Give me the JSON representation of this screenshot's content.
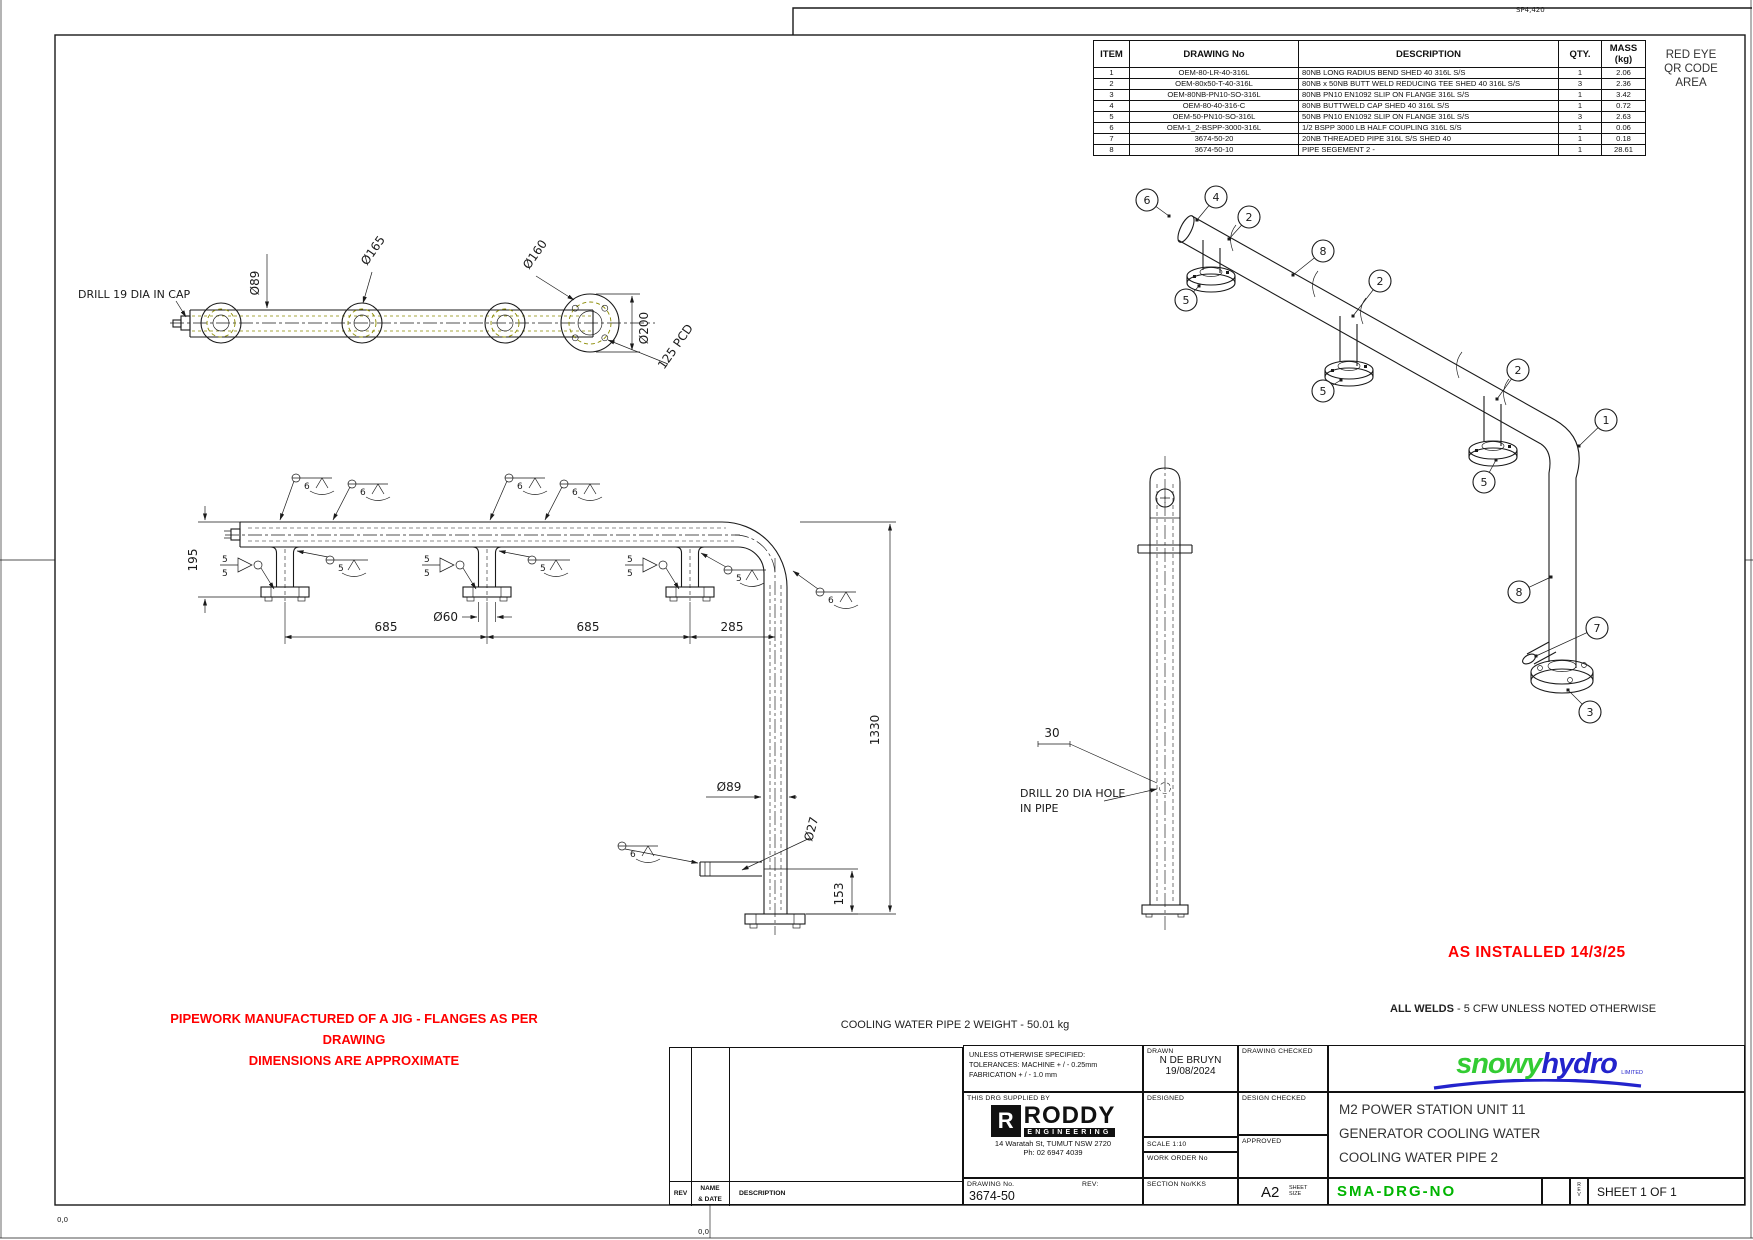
{
  "sheet": {
    "sp_mark": "SP4,420",
    "origin_a": "0,0",
    "origin_b": "0,0"
  },
  "qr_area": {
    "l1": "RED EYE",
    "l2": "QR CODE",
    "l3": "AREA"
  },
  "bom": {
    "headers": [
      "ITEM",
      "DRAWING No",
      "DESCRIPTION",
      "QTY.",
      "MASS (kg)"
    ],
    "rows": [
      [
        "1",
        "OEM-80-LR-40-316L",
        "80NB LONG RADIUS BEND SHED 40 316L S/S",
        "1",
        "2.06"
      ],
      [
        "2",
        "OEM-80x50-T-40-316L",
        "80NB x 50NB BUTT WELD REDUCING TEE SHED 40 316L S/S",
        "3",
        "2.36"
      ],
      [
        "3",
        "OEM-80NB-PN10-SO-316L",
        "80NB PN10 EN1092 SLIP ON FLANGE 316L S/S",
        "1",
        "3.42"
      ],
      [
        "4",
        "OEM-80-40-316-C",
        "80NB BUTTWELD CAP SHED 40 316L S/S",
        "1",
        "0.72"
      ],
      [
        "5",
        "OEM-50-PN10-SO-316L",
        "50NB PN10 EN1092 SLIP ON FLANGE 316L S/S",
        "3",
        "2.63"
      ],
      [
        "6",
        "OEM-1_2-BSPP-3000-316L",
        "1/2 BSPP 3000 LB HALF COUPLING 316L S/S",
        "1",
        "0.06"
      ],
      [
        "7",
        "3674-50-20",
        "20NB THREADED PIPE 316L S/S SHED 40",
        "1",
        "0.18"
      ],
      [
        "8",
        "3674-50-10",
        "PIPE SEGEMENT 2 -",
        "1",
        "28.61"
      ]
    ]
  },
  "notes": {
    "as_installed": "AS INSTALLED 14/3/25",
    "welds_bold": "ALL WELDS",
    "welds_rest": " - 5 CFW UNLESS NOTED OTHERWISE",
    "jig1": "PIPEWORK MANUFACTURED OF A JIG - FLANGES AS PER DRAWING",
    "jig2": "DIMENSIONS ARE APPROXIMATE",
    "weight": "COOLING WATER PIPE 2 WEIGHT -   50.01 kg"
  },
  "dims": {
    "drill19": "DRILL 19 DIA IN CAP",
    "d89_top": "Ø89",
    "d165": "Ø165",
    "d160": "Ø160",
    "d200": "Ø200",
    "pcd": "125 PCD",
    "h195": "195",
    "len685a": "685",
    "len685b": "685",
    "len285": "285",
    "d60": "Ø60",
    "d89_front": "Ø89",
    "v1330": "1330",
    "d27": "Ø27",
    "v153": "153",
    "off30": "30",
    "drill20_1": "DRILL 20 DIA HOLE",
    "drill20_2": "IN PIPE"
  },
  "welds": {
    "five": "5",
    "six": "6"
  },
  "iso": {
    "balloons": [
      "6",
      "4",
      "2",
      "8",
      "2",
      "5",
      "5",
      "2",
      "5",
      "1",
      "8",
      "7",
      "3"
    ]
  },
  "title_block": {
    "tol1": "UNLESS OTHERWISE SPECIFIED:",
    "tol2": "TOLERANCES: MACHINE + / - 0.25mm",
    "tol3": "FABRICATION + / - 1.0 mm",
    "supplied": "THIS DRG SUPPLIED BY",
    "roddy_r": "R",
    "roddy": "RODDY",
    "roddy_sub": "ENGINEERING",
    "addr1": "14 Waratah St, TUMUT NSW 2720",
    "addr2": "Ph: 02 6947 4039",
    "drg_no_label": "DRAWING No.",
    "rev_label": "REV:",
    "drg_no": "3674-50",
    "drawn_label": "DRAWN",
    "drawn_name": "N DE BRUYN",
    "drawn_date": "19/08/2024",
    "drawing_checked": "DRAWING CHECKED",
    "designed": "DESIGNED",
    "design_checked": "DESIGN CHECKED",
    "scale": "SCALE   1:10",
    "work_order": "WORK ORDER No",
    "approved": "APPROVED",
    "section": "SECTION No/KKS",
    "size": "A2",
    "size_l1": "SHEET",
    "size_l2": "SIZE",
    "title1": "M2 POWER STATION UNIT 11",
    "title2": "GENERATOR COOLING WATER",
    "title3": "COOLING WATER PIPE 2",
    "sma": "SMA-DRG-NO",
    "sheet": "SHEET 1 OF 1",
    "rev_v1": "R",
    "rev_v2": "E",
    "rev_v3": "V",
    "snowy": "snowy",
    "hydro": "hydro",
    "limited": "LIMITED"
  },
  "rev_table": {
    "rev": "REV",
    "name1": "NAME",
    "name2": "& DATE",
    "desc": "DESCRIPTION"
  },
  "colors": {
    "red": "#ff0000",
    "green": "#00b400",
    "snowy_green": "#33cc33",
    "hydro_blue": "#2323cc",
    "line": "#1a1a1a",
    "bolt_olive": "#8a8a00"
  }
}
